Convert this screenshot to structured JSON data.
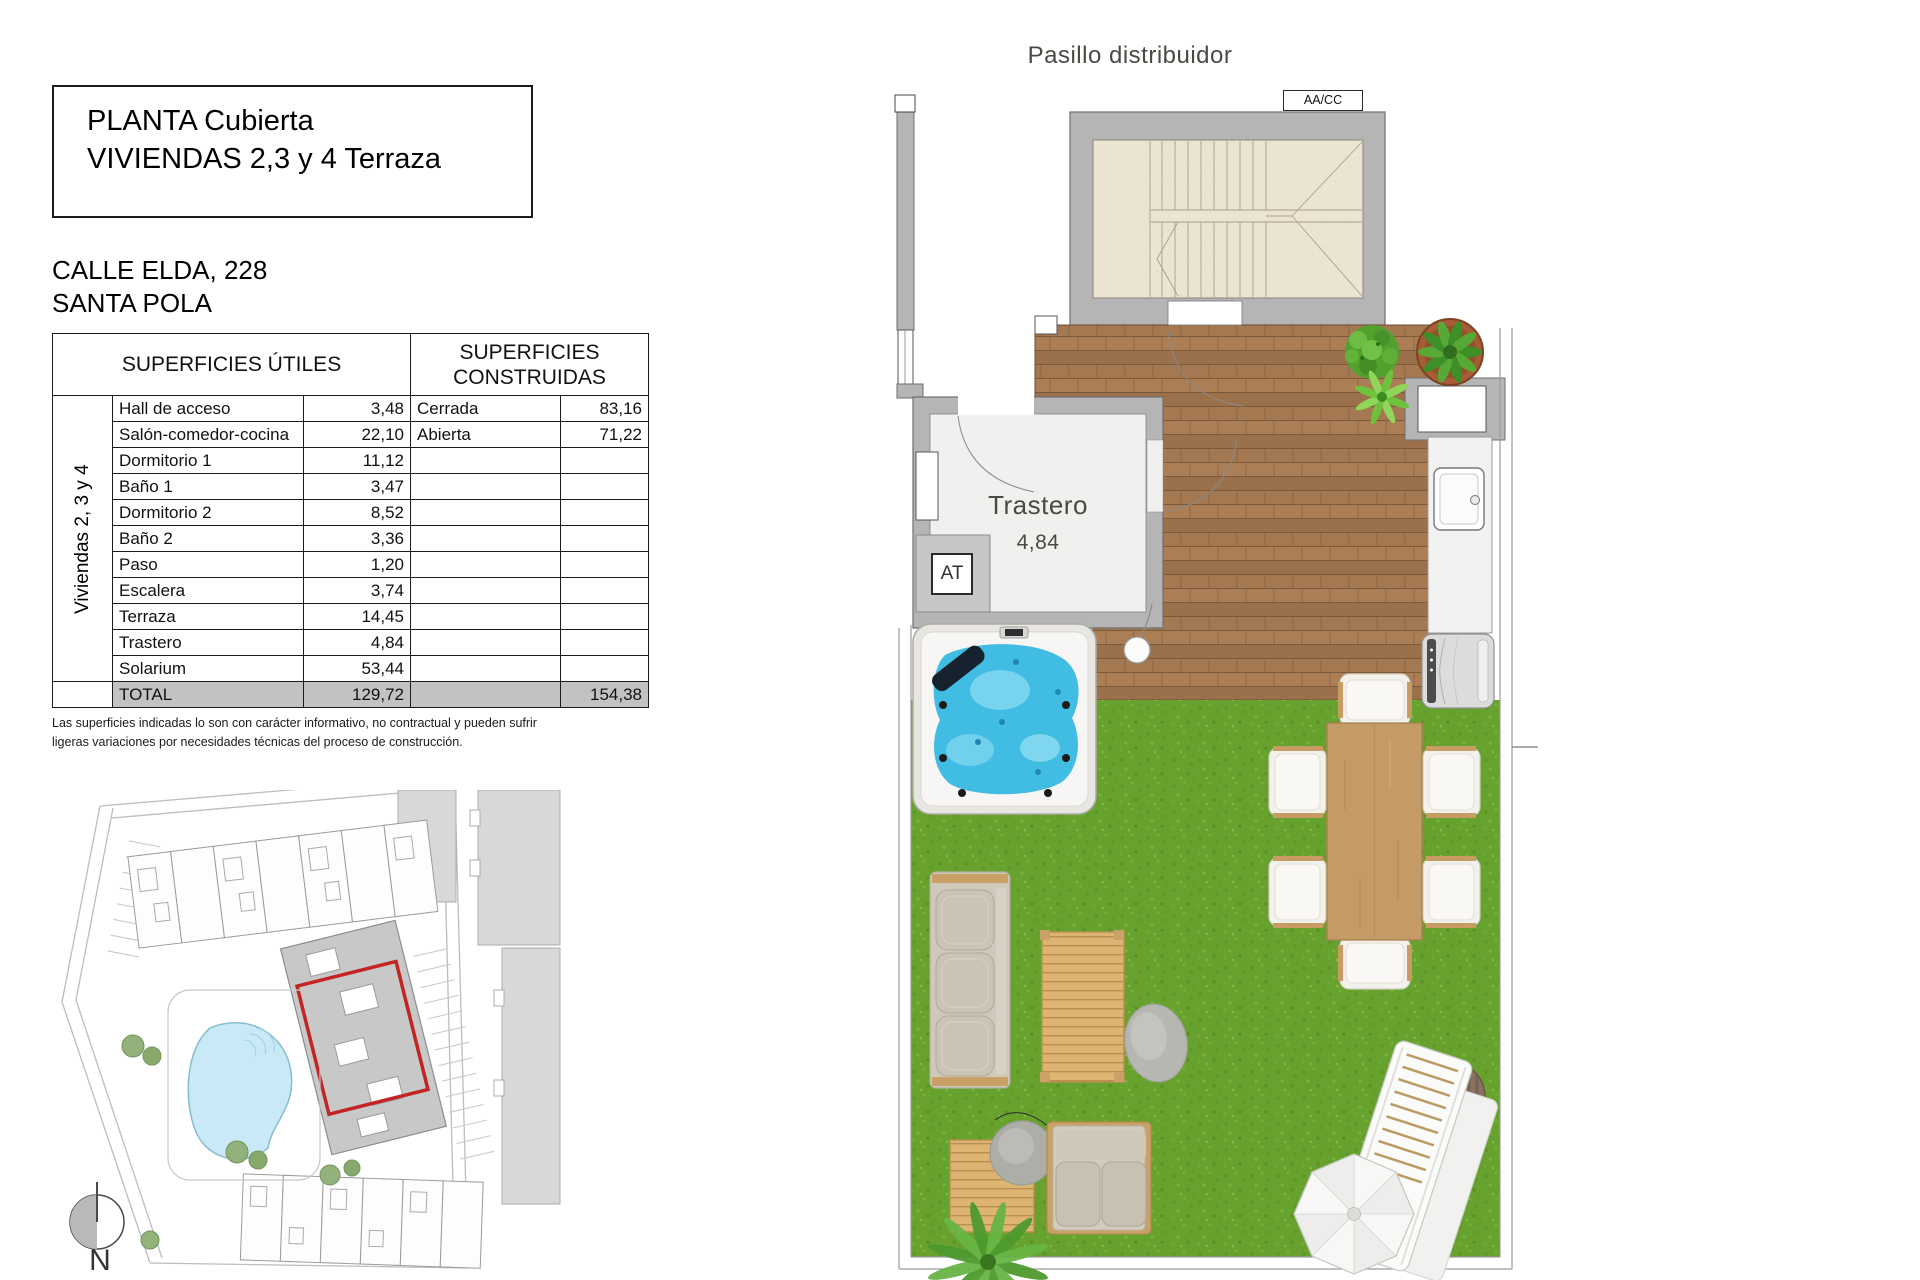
{
  "title_block": {
    "line1": "PLANTA Cubierta",
    "line2": "VIVIENDAS 2,3 y 4 Terraza"
  },
  "address": {
    "line1": "CALLE ELDA, 228",
    "line2": "SANTA POLA"
  },
  "surfaces_table": {
    "header_utiles": "SUPERFICIES ÚTILES",
    "header_construidas": "SUPERFICIES CONSTRUIDAS",
    "group_label": "Viviendas 2, 3 y 4",
    "rows": [
      {
        "name": "Hall de acceso",
        "value": "3,48",
        "c_name": "Cerrada",
        "c_value": "83,16"
      },
      {
        "name": "Salón-comedor-cocina",
        "value": "22,10",
        "c_name": "Abierta",
        "c_value": "71,22"
      },
      {
        "name": "Dormitorio 1",
        "value": "11,12",
        "c_name": "",
        "c_value": ""
      },
      {
        "name": "Baño 1",
        "value": "3,47",
        "c_name": "",
        "c_value": ""
      },
      {
        "name": "Dormitorio 2",
        "value": "8,52",
        "c_name": "",
        "c_value": ""
      },
      {
        "name": "Baño 2",
        "value": "3,36",
        "c_name": "",
        "c_value": ""
      },
      {
        "name": "Paso",
        "value": "1,20",
        "c_name": "",
        "c_value": ""
      },
      {
        "name": "Escalera",
        "value": "3,74",
        "c_name": "",
        "c_value": ""
      },
      {
        "name": "Terraza",
        "value": "14,45",
        "c_name": "",
        "c_value": ""
      },
      {
        "name": "Trastero",
        "value": "4,84",
        "c_name": "",
        "c_value": ""
      },
      {
        "name": "Solarium",
        "value": "53,44",
        "c_name": "",
        "c_value": ""
      }
    ],
    "total": {
      "label": "TOTAL",
      "utiles": "129,72",
      "construidas": "154,38"
    }
  },
  "disclaimer": {
    "line1": "Las superficies indicadas lo son con carácter informativo, no contractual y pueden sufrir",
    "line2": "ligeras variaciones por necesidades técnicas del proceso de construcción."
  },
  "floorplan": {
    "corridor_label": "Pasillo distribuidor",
    "ac_label": "AA/CC",
    "room_label": "Trastero",
    "room_area": "4,84",
    "at_label": "AT"
  },
  "siteplan": {
    "compass_label": "N"
  },
  "colors": {
    "highlight_red": "#c32424",
    "wall_gray": "#b5b5b5",
    "grass_green": "#67a22e",
    "deck_brown": "#a2764f",
    "water_blue": "#41bce3",
    "pool_blue": "#c8e9f5"
  }
}
